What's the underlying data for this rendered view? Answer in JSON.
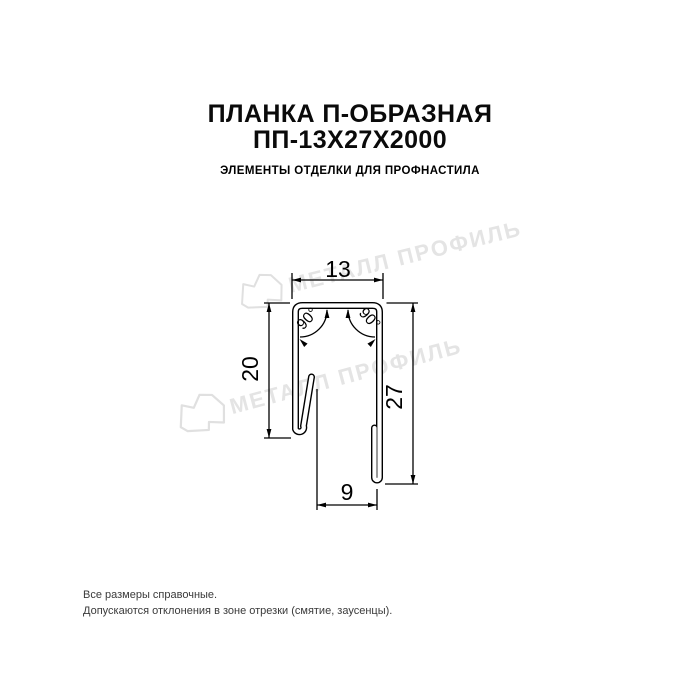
{
  "header": {
    "title_line1": "ПЛАНКА П-ОБРАЗНАЯ",
    "title_line2": "ПП-13Х27Х2000",
    "subtitle": "ЭЛЕМЕНТЫ ОТДЕЛКИ ДЛЯ ПРОФНАСТИЛА"
  },
  "drawing": {
    "dimensions": {
      "top_width": "13",
      "left_height": "20",
      "right_height": "27",
      "bottom_width": "9"
    },
    "angles": {
      "left": "90°",
      "right": "90°"
    }
  },
  "watermark": {
    "text": "МЕТАЛЛ ПРОФИЛЬ",
    "color": "#e4e4e4",
    "logo_color": "#e0e0e0"
  },
  "footer": {
    "line1": "Все размеры справочные.",
    "line2": "Допускаются отклонения в зоне отрезки (смятие, заусенцы)."
  },
  "colors": {
    "background": "#ffffff",
    "drawing_line": "#000000",
    "text": "#0a0a0a",
    "footer_text": "#3a3a3a"
  }
}
